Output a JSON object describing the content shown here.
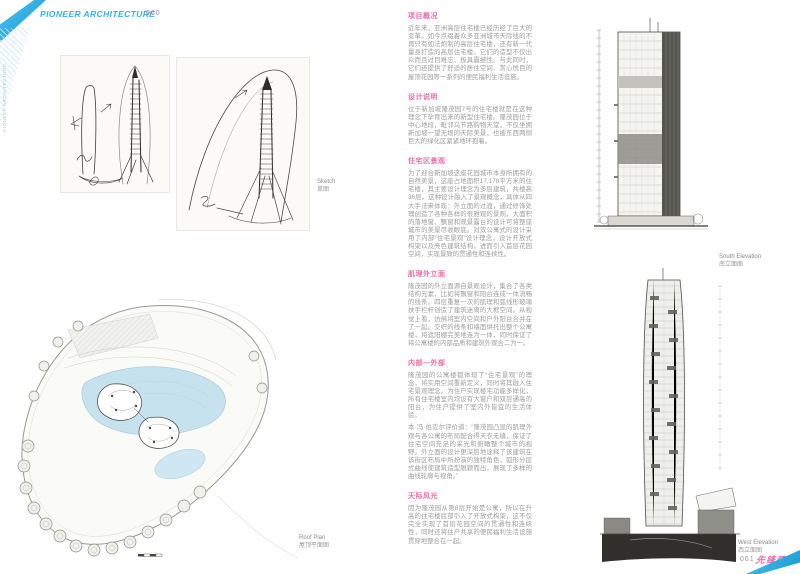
{
  "header": {
    "brand": "PIONEER ARCHITECTURE",
    "page_number": "060",
    "side_label": "PIONEER ARCHITECTURE"
  },
  "footer": {
    "page_number": "061",
    "brand_cn": "先锋建筑"
  },
  "figures": {
    "sketch": {
      "label_en": "Sketch",
      "label_cn": "草图"
    },
    "south_elevation": {
      "label_en": "South Elevation",
      "label_cn": "南立面图"
    },
    "west_elevation": {
      "label_en": "West Elevation",
      "label_cn": "西立面图"
    },
    "roof_plan": {
      "label_en": "Roof Plan",
      "label_cn": "屋顶平面图"
    }
  },
  "article": {
    "sections": [
      {
        "heading": "项目概况",
        "paragraphs": [
          "近年来，亚洲高层住宅楼已经历经了巨大的变革。如今点缀着众多亚洲城市天际线的不再只有如法炮制的高层住宅楼，还有新一代量身打造的高层住宅楼。它们的造型不仅出众而且过目难忘、极具震撼性。与此同时，它们还提供了舒适的居住空间、赏心悦目的屋顶花园等一系列的便民福利生活设施。"
        ]
      },
      {
        "heading": "设计说明",
        "paragraphs": [
          "位于新加坡隆茂园7号的住宅楼就是在这种理念下孕育出来的新型住宅楼。隆茂园位于中心地段，毗邻乌节路购物天堂，不仅坐拥新加坡一望无垠的天际美景，也被东西两侧巨大的绿化区紧紧地环抱着。"
        ]
      },
      {
        "heading": "住宅区景观",
        "paragraphs": [
          "为了迎合新加坡这座花园城市本身所拥有的自然美景，这座占地面积17,178平方米的住宅楼，其主要设计理念为多层建筑，共楼高36层。这种设计融入了景观概念，具体从四大手法来体现：外立面的过渡，通过修饰处理创造了各种各样的很雅观的景观，大面积的落地窗、飘窗和观景露台的设计可将整座城市的美景尽收眼底。对双公寓式的设计采用了内部“住宅景观”设计理念，设计开放式构架以及亮色建筑结构，进而引入首层花园空间，实现景致的贯通性和连续性。"
        ]
      },
      {
        "heading": "肌理外立面",
        "paragraphs": [
          "隆茂园的外立面源自景观设计，集合了各类结构元素，比如将飘窗和阳台连成一体流畅的线条。四层重复一次的肌理和弧线形玻璃扶手栏杆创造了建筑迷离的大框空间。从视觉上看，仿佛将室内空间和户外阳台合并在了一起。交织的线条和墙面烘托出整个公寓楼，将遮阳棚完美地连为一体，同时保证了将公寓楼的内部品质和建筑外观合二为一。"
        ]
      },
      {
        "heading": "内部—外部",
        "paragraphs": [
          "隆茂园的公寓楼都体现了“住宅景观”的理念，将实用空间重新定义，同时将其融入住宅景观理念。为住户实现楼宅功能多样化，所有住宅楼室内均设有大窗户和双层通高的阳台，为住户提供了室内外皆宜的生活体验。",
          "本·冯·伯克尔评价道：“隆茂园凸显的肌理外观与各公寓的布局配合得天衣无缝，保证了住宅空间充足的采光和俯瞰整个城市的视野。外立面的设计更深层地诠释了该建筑在该街区布局中所扮演的独特角色，弧形分层式曲线使建筑造型脱颖而出，展现了多样的曲线轮廓与视角。”"
        ]
      },
      {
        "heading": "天际风光",
        "paragraphs": [
          "因为隆茂园从第8层开始是公寓，所以在升高的住宅楼底部引入了开放式构架，这不仅完全实现了首层花园空间的贯通性和连续性，同时还将住户共享的便民福利生活设施贯穿地整合在一起。"
        ]
      }
    ]
  },
  "colors": {
    "accent_cyan": "#2fb0e6",
    "accent_pink": "#f06ba8",
    "body_text": "#9c9c9c"
  }
}
